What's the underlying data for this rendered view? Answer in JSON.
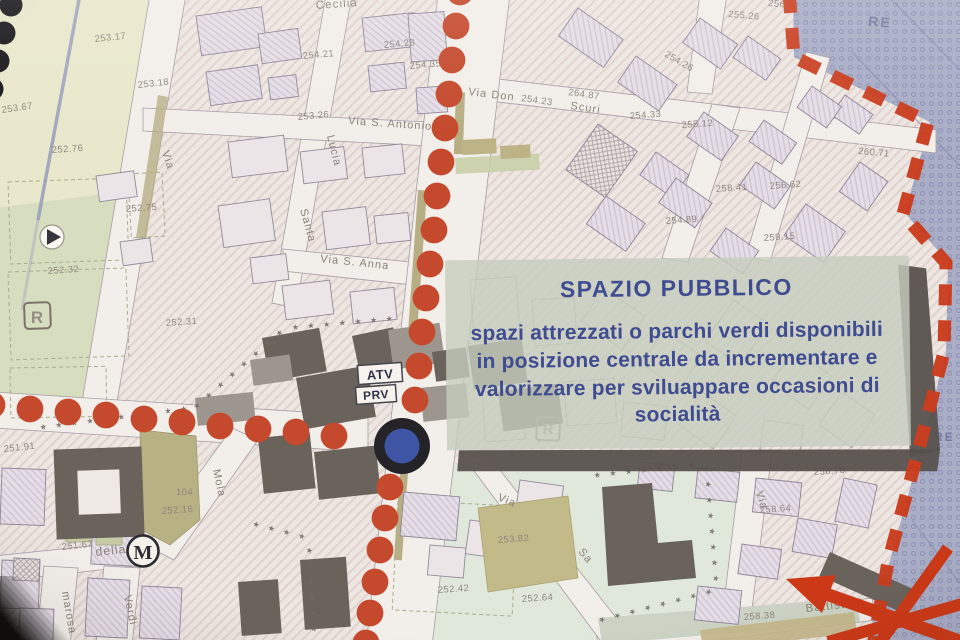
{
  "annotation_box": {
    "title": "SPAZIO PUBBLICO",
    "lines": [
      "spazi attrezzati o parchi verdi disponibili",
      "in posizione centrale da incrementare e",
      "valorizzare per sviluappare occasioni di",
      "socialità"
    ],
    "text_color": "#3f4c90",
    "bg_color": "#c6cdbe",
    "shadow_color": "#57514c"
  },
  "map": {
    "street_labels": [
      "Cecilia",
      "Lucia",
      "Santa",
      "Via",
      "Via S. Antonio",
      "Via S. Anna",
      "Via Don",
      "Scuri",
      "Mola",
      "della",
      "marosa",
      "Verdi",
      "Battista",
      "Via",
      "Via",
      "Sa"
    ],
    "elevation_labels": [
      "253.17",
      "253.67",
      "253.18",
      "252.76",
      "252.75",
      "252.32",
      "252.31",
      "254.21",
      "254.28",
      "254.35",
      "253.26",
      "254.23",
      "264.87",
      "256.51",
      "255.26",
      "254.26",
      "254.33",
      "255.12",
      "260.71",
      "258.41",
      "256.62",
      "254.89",
      "259.15",
      "251.91",
      "251.67",
      "104",
      "252.16",
      "253.82",
      "252.42",
      "252.64",
      "258.64",
      "258.78",
      "258.38"
    ],
    "symbols": {
      "metro": "M",
      "reserved_area_1": "R",
      "reserved_area_2": "R",
      "zone_top": "RE",
      "zone_bottom": "RE",
      "label_atv": "ATV",
      "label_prv": "PRV"
    },
    "star_chain": "★ ★ ★ ★ ★ ★ ★ ★ ★ ★ ★ ★ ★ ★ ★ ★ ★ ★ ★ ★ ★ ★ ★ ★ ★ ★ ★ ★ ★ ★ ★ ★ ★ ★ ★ ★",
    "colors": {
      "route_red": "#c5492c",
      "boundary_red": "#c93c1e",
      "node_blue": "#3e55a3",
      "node_ring": "#232328",
      "zone_purple": "#a9adc6",
      "park_green": "#d7dec0",
      "mint_green": "#dfe8db",
      "arrow_red": "#cc3917"
    }
  }
}
